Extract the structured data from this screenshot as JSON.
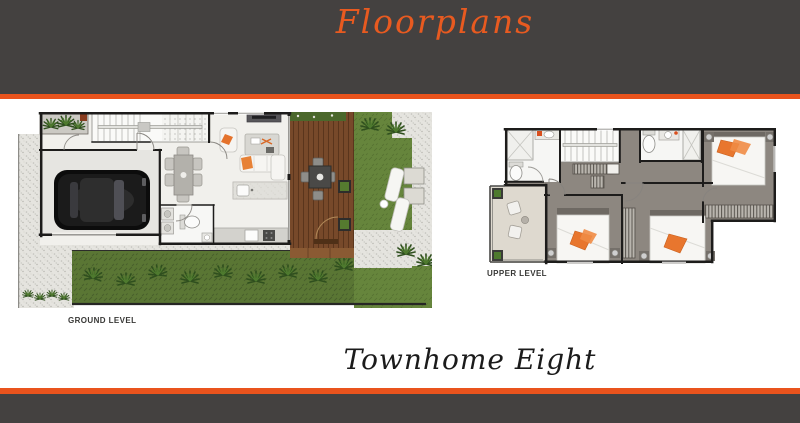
{
  "banner": {
    "title": "Floorplans"
  },
  "plans": {
    "ground": {
      "label": "GROUND LEVEL"
    },
    "upper": {
      "label": "UPPER LEVEL"
    }
  },
  "footer_title": "Townhome Eight",
  "colors": {
    "banner_dark": "#444140",
    "accent_orange": "#e9531d",
    "script_orange": "#e85a20",
    "lawn_green": "#66853c",
    "garden_green": "#5a7634",
    "deck_brown": "#77492a",
    "carpet_gray": "#8d8780",
    "wall_black": "#1d1c1b",
    "page_bg": "#ffffff"
  }
}
